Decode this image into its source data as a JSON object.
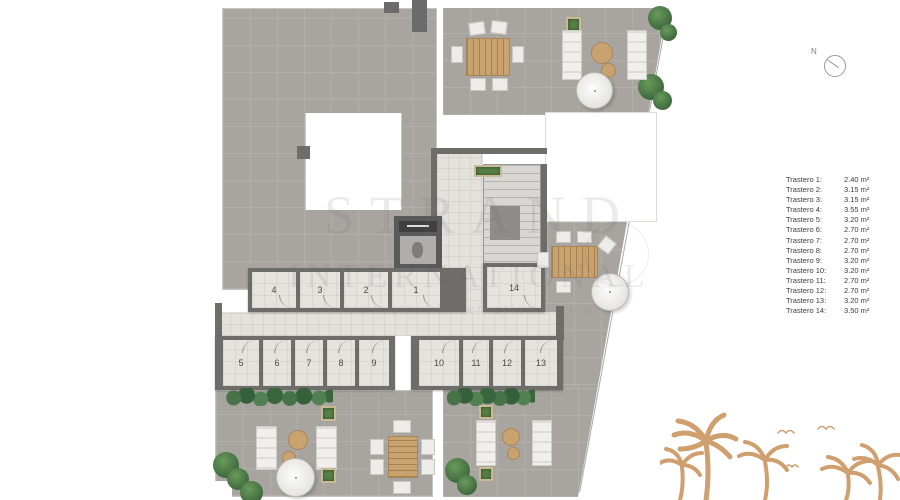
{
  "compass": {
    "label": "N"
  },
  "watermark": {
    "brand_top": "STRAND",
    "brand_bottom": "INTERNATIONAL",
    "website": "www.strandinternational.com"
  },
  "plan": {
    "rooms_top": [
      "4",
      "3",
      "2",
      "1"
    ],
    "room_right": "14",
    "rooms_bottom_left": [
      "5",
      "6",
      "7",
      "8",
      "9"
    ],
    "rooms_bottom_right": [
      "10",
      "11",
      "12",
      "13"
    ]
  },
  "legend": {
    "items": [
      {
        "label": "Trastero 1:",
        "value": "2.40 m²"
      },
      {
        "label": "Trastero 2:",
        "value": "3.15 m²"
      },
      {
        "label": "Trastero 3:",
        "value": "3.15 m²"
      },
      {
        "label": "Trastero 4:",
        "value": "3.55 m²"
      },
      {
        "label": "Trastero 5:",
        "value": "3.20 m²"
      },
      {
        "label": "Trastero 6:",
        "value": "2.70 m²"
      },
      {
        "label": "Trastero 7:",
        "value": "2.70 m²"
      },
      {
        "label": "Trastero 8:",
        "value": "2.70 m²"
      },
      {
        "label": "Trastero 9:",
        "value": "3.20 m²"
      },
      {
        "label": "Trastero 10:",
        "value": "3.20 m²"
      },
      {
        "label": "Trastero 11:",
        "value": "2.70 m²"
      },
      {
        "label": "Trastero 12:",
        "value": "2.70 m²"
      },
      {
        "label": "Trastero 13:",
        "value": "3.20 m²"
      },
      {
        "label": "Trastero 14:",
        "value": "3.50 m²"
      }
    ]
  },
  "colors": {
    "terrace_gray": "#a8a5a1",
    "wall_gray": "#6f6d6a",
    "floor_light": "#e4e3de",
    "hedge_green": "#3a663d",
    "wood_tan": "#c9a36f",
    "palm_tan": "#cf9f6d",
    "legend_text": "#3d3d3d"
  }
}
